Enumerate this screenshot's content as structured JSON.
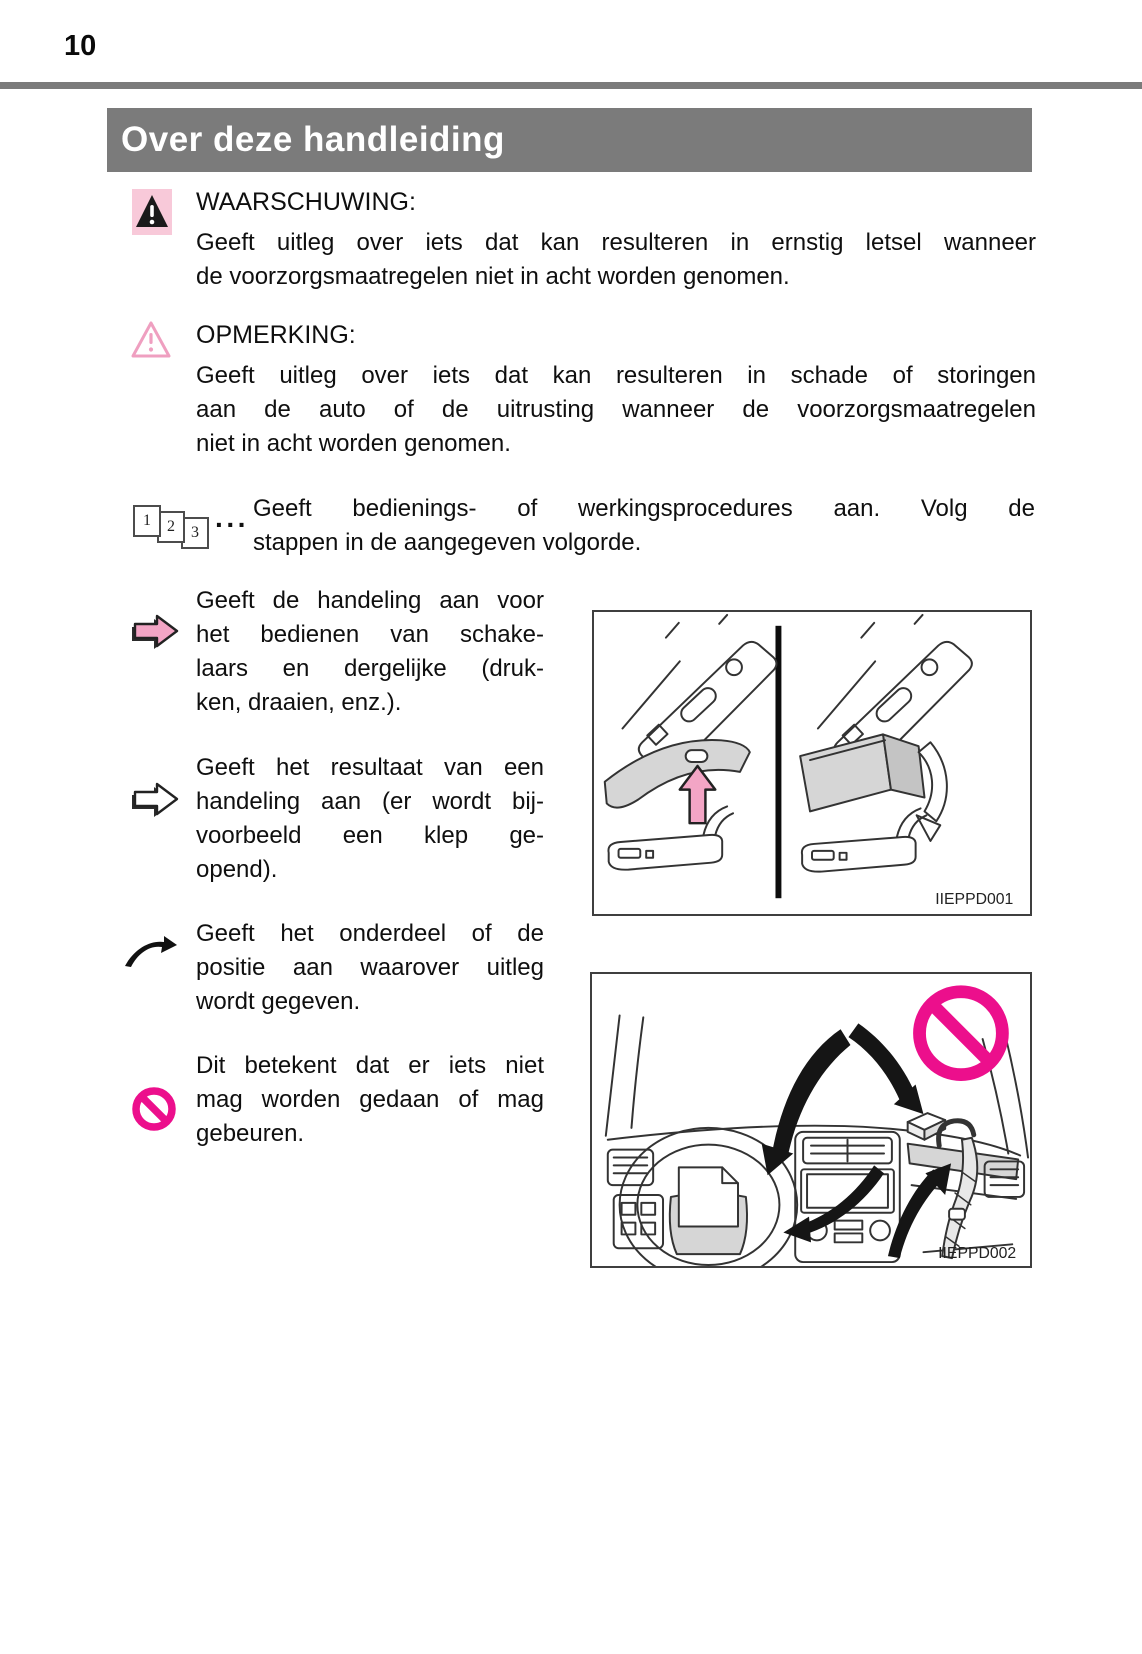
{
  "page_number": "10",
  "header": {
    "title": "Over deze handleiding"
  },
  "legend": {
    "warning": {
      "label": "WAARSCHUWING:",
      "lines": [
        "Geeft uitleg over iets dat kan resulteren in ernstig letsel wanneer",
        "de voorzorgsmaatregelen niet in acht worden genomen."
      ]
    },
    "notice": {
      "label": "OPMERKING:",
      "lines": [
        "Geeft uitleg over iets dat kan resulteren in schade of storingen",
        "aan de auto of de uitrusting wanneer de voorzorgsmaatregelen",
        "niet in acht worden genomen."
      ]
    },
    "steps": {
      "numbers": [
        "1",
        "2",
        "3"
      ],
      "dots": "···",
      "lines": [
        "Geeft bedienings- of werkingsprocedures aan. Volg de",
        "stappen in de aangegeven volgorde."
      ]
    },
    "action_arrow": {
      "lines": [
        "Geeft de handeling aan voor",
        "het bedienen van schake-",
        "laars en dergelijke (druk-",
        "ken, draaien, enz.)."
      ]
    },
    "result_arrow": {
      "lines": [
        "Geeft het resultaat van een",
        "handeling aan (er wordt bij-",
        "voorbeeld een klep ge-",
        "opend)."
      ]
    },
    "part_pointer": {
      "lines": [
        "Geeft het onderdeel of de",
        "positie aan waarover uitleg",
        "wordt gegeven."
      ]
    },
    "prohibition": {
      "lines": [
        "Dit betekent dat er iets niet",
        "mag worden gedaan of mag",
        "gebeuren."
      ]
    }
  },
  "figures": {
    "fig1": {
      "code": "IIEPPD001"
    },
    "fig2": {
      "code": "IIEPPD002"
    }
  },
  "colors": {
    "header_gray": "#7b7b7b",
    "warning_pink_bg": "#f8c9d9",
    "pink": "#f3a5c5",
    "magenta": "#ec0f8c"
  }
}
